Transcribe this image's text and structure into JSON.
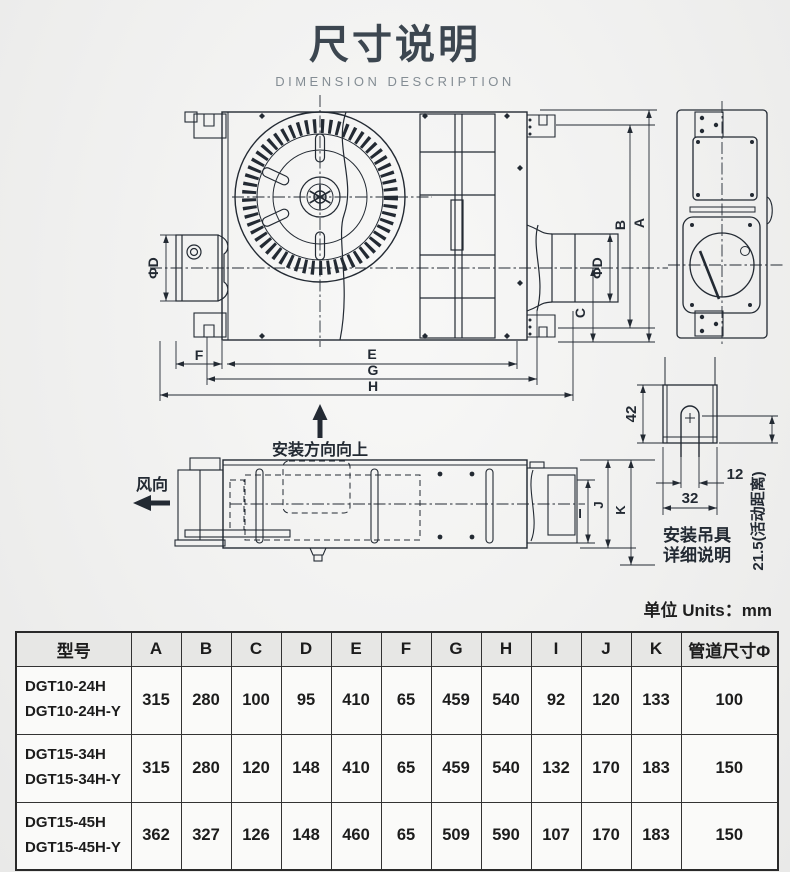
{
  "page": {
    "title": "尺寸说明",
    "subtitle": "DIMENSION DESCRIPTION",
    "units_label": "单位 Units：mm"
  },
  "drawing": {
    "labels": {
      "phi_d_left": "ΦD",
      "phi_d_right": "ΦD",
      "dim_a": "A",
      "dim_b": "B",
      "dim_c": "C",
      "dim_e": "E",
      "dim_f": "F",
      "dim_g": "G",
      "dim_h": "H",
      "dim_i": "I",
      "dim_j": "J",
      "dim_k": "K",
      "install_direction": "安装方向向上",
      "wind_direction": "风向",
      "bracket_42": "42",
      "bracket_12": "12",
      "bracket_32": "32",
      "bracket_215": "21.5(活动距离)",
      "hanger_caption_1": "安装吊具",
      "hanger_caption_2": "详细说明"
    }
  },
  "table": {
    "headers": [
      "型号",
      "A",
      "B",
      "C",
      "D",
      "E",
      "F",
      "G",
      "H",
      "I",
      "J",
      "K",
      "管道尺寸Φ"
    ],
    "rows": [
      {
        "model": [
          "DGT10-24H",
          "DGT10-24H-Y"
        ],
        "values": [
          "315",
          "280",
          "100",
          "95",
          "410",
          "65",
          "459",
          "540",
          "92",
          "120",
          "133",
          "100"
        ]
      },
      {
        "model": [
          "DGT15-34H",
          "DGT15-34H-Y"
        ],
        "values": [
          "315",
          "280",
          "120",
          "148",
          "410",
          "65",
          "459",
          "540",
          "132",
          "170",
          "183",
          "150"
        ]
      },
      {
        "model": [
          "DGT15-45H",
          "DGT15-45H-Y"
        ],
        "values": [
          "362",
          "327",
          "126",
          "148",
          "460",
          "65",
          "509",
          "590",
          "107",
          "170",
          "183",
          "150"
        ]
      }
    ]
  },
  "colors": {
    "line": "#232a33",
    "title": "#3c4650",
    "subtitle": "#848d94"
  }
}
